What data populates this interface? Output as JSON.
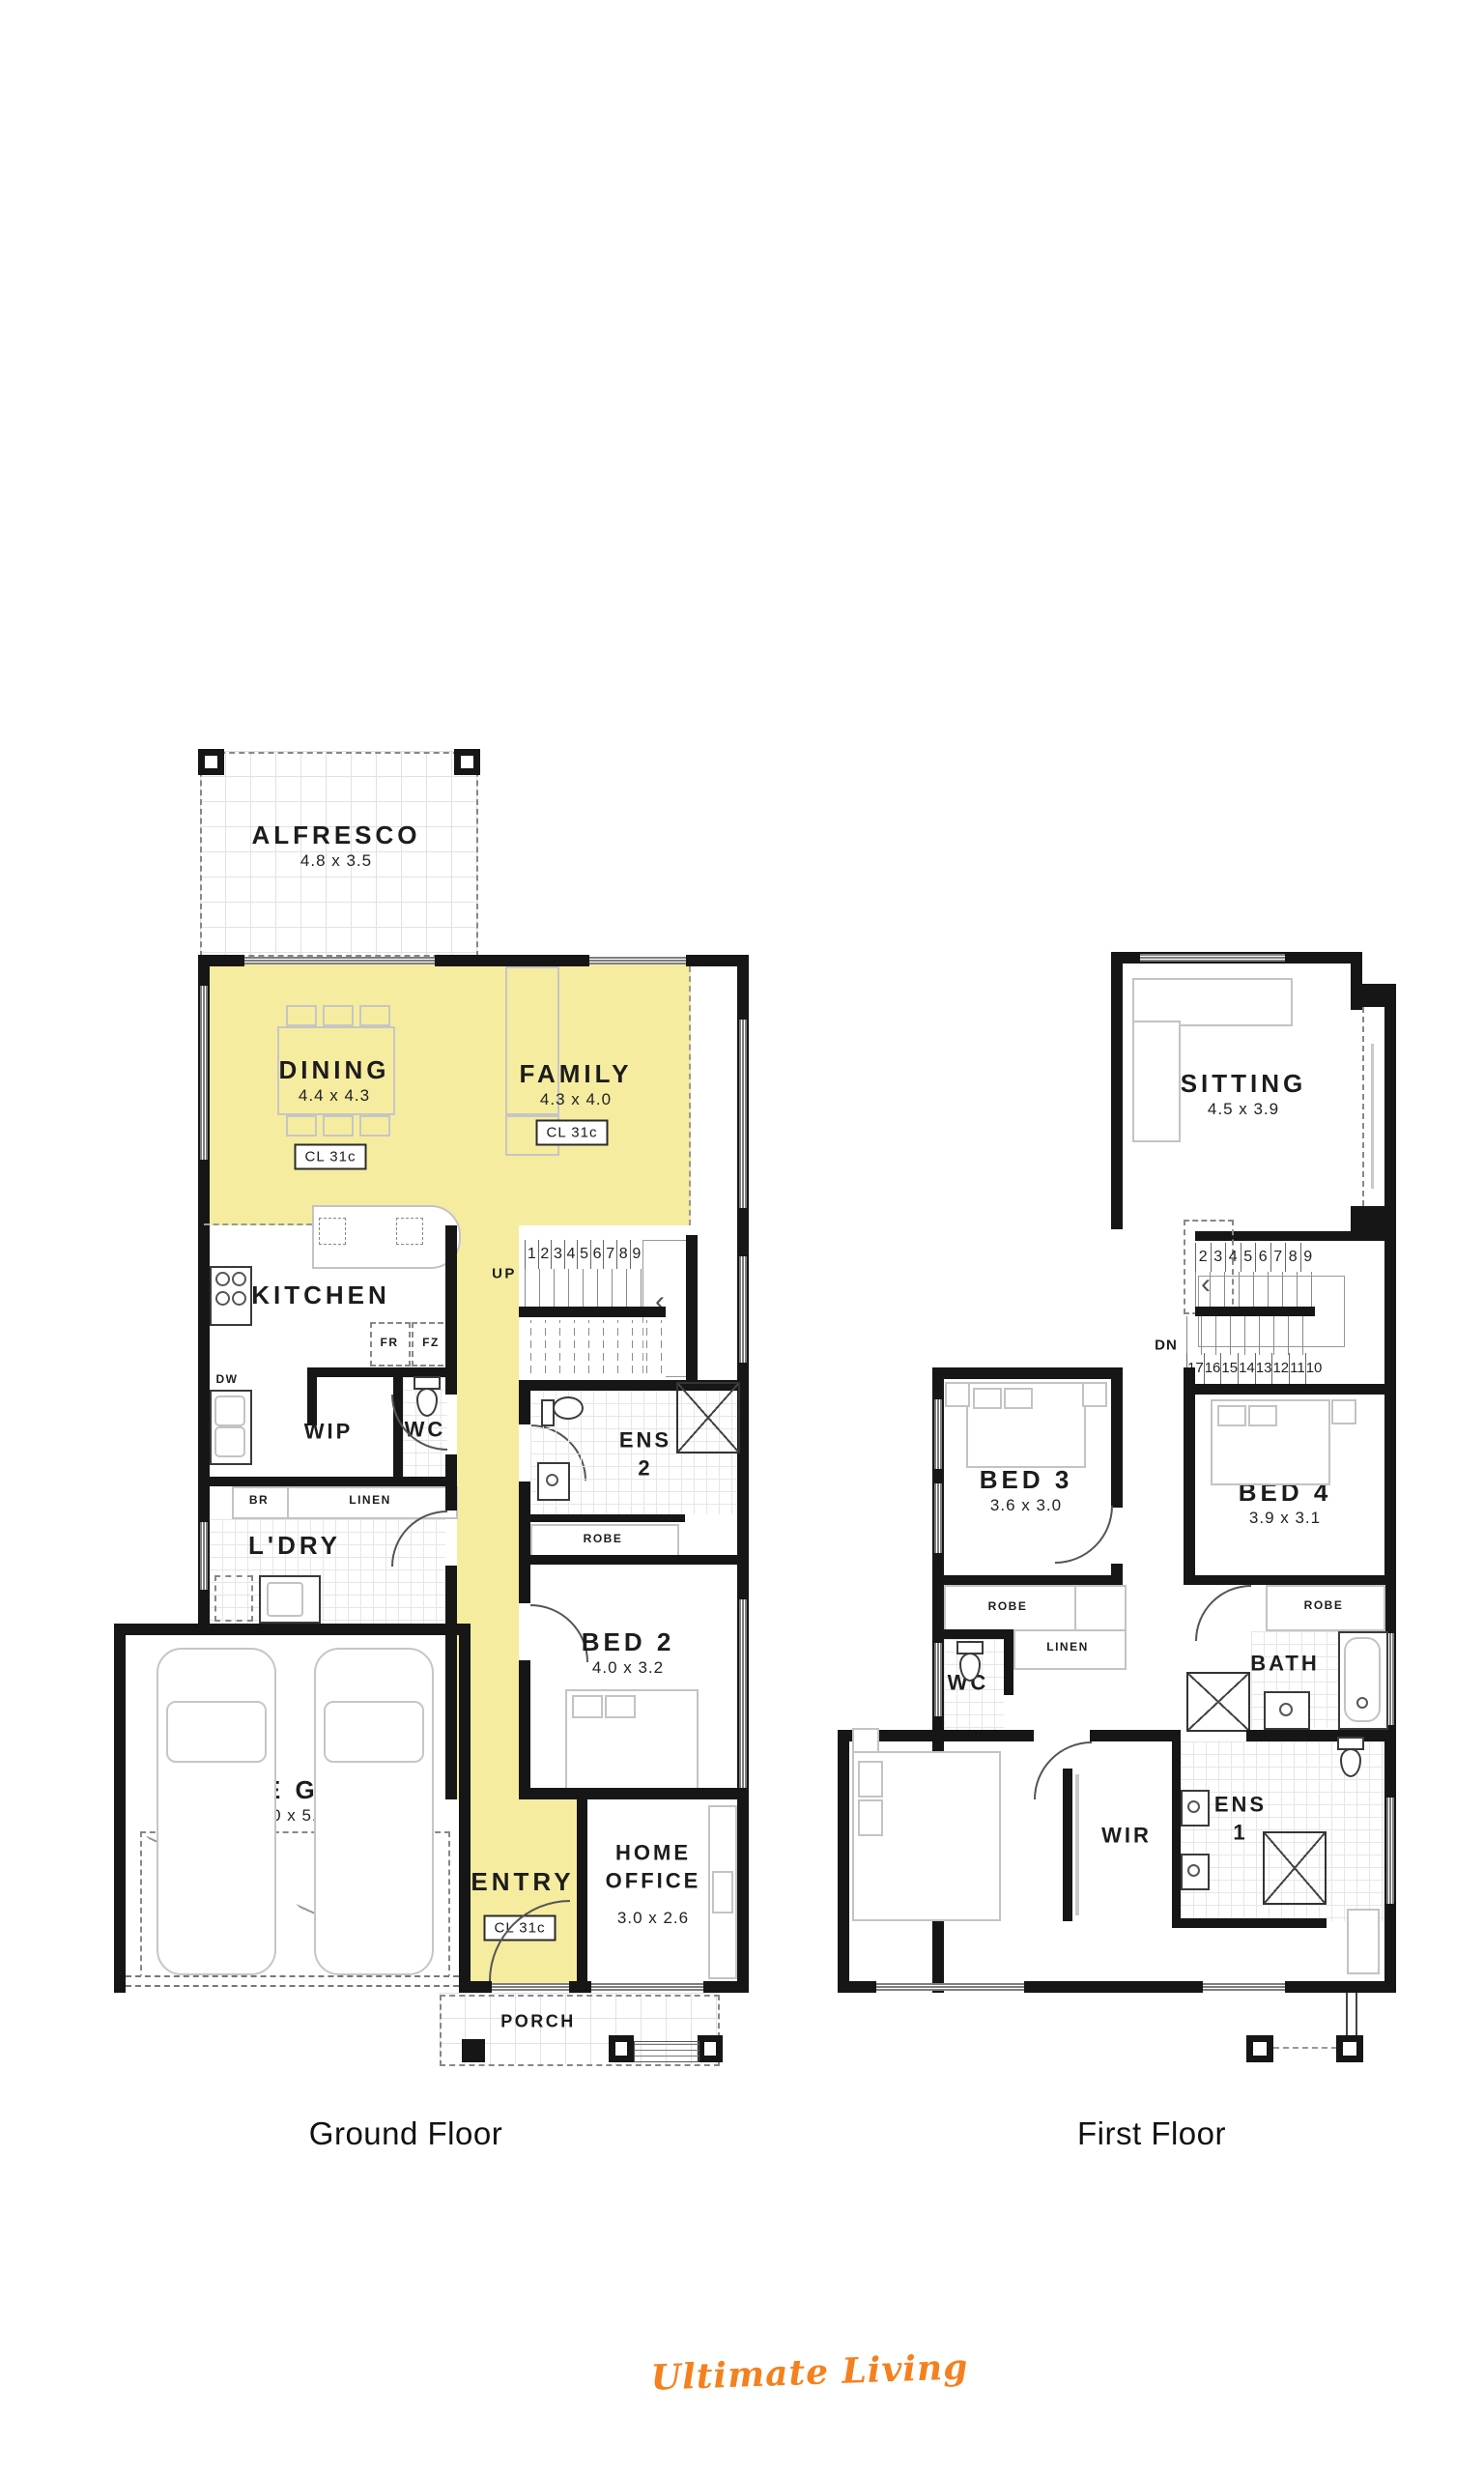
{
  "gf": {
    "caption": "Ground Floor",
    "alfresco_name": "ALFRESCO",
    "alfresco_dim": "4.8 x 3.5",
    "dining_name": "DINING",
    "dining_dim": "4.4 x 4.3",
    "dining_cl": "CL 31c",
    "family_name": "FAMILY",
    "family_dim": "4.3 x 4.0",
    "family_cl": "CL 31c",
    "kitchen_name": "KITCHEN",
    "wip_name": "WIP",
    "wc_name": "WC",
    "ens2_name": "ENS\n2",
    "ldry_name": "L'DRY",
    "bed2_name": "BED 2",
    "bed2_dim": "4.0 x 3.2",
    "garage_name": "DOUBLE GARAGE",
    "garage_dim": "6.0 x 5.9",
    "entry_name": "ENTRY",
    "entry_cl": "CL 31c",
    "office_name": "HOME\nOFFICE",
    "office_dim": "3.0 x 2.6",
    "porch_name": "PORCH",
    "up_label": "UP",
    "fr": "FR",
    "fz": "FZ",
    "dw": "DW",
    "br": "BR",
    "linen": "LINEN",
    "robe": "ROBE",
    "stairs": [
      "1",
      "2",
      "3",
      "4",
      "5",
      "6",
      "7",
      "8",
      "9"
    ]
  },
  "ff": {
    "caption": "First Floor",
    "sitting_name": "SITTING",
    "sitting_dim": "4.5 x 3.9",
    "bed3_name": "BED 3",
    "bed3_dim": "3.6 x 3.0",
    "bed4_name": "BED 4",
    "bed4_dim": "3.9 x 3.1",
    "bed1_name": "BED 1",
    "bed1_dim": "4.1 x 4.0",
    "wc_name": "WC",
    "bath_name": "BATH",
    "wir_name": "WIR",
    "ens1_name": "ENS\n1",
    "linen": "LINEN",
    "robe_bed3": "ROBE",
    "robe_bed4": "ROBE",
    "dn_label": "DN",
    "stairs_top": [
      "2",
      "3",
      "4",
      "5",
      "6",
      "7",
      "8",
      "9"
    ],
    "stairs_bottom": [
      "17",
      "16",
      "15",
      "14",
      "13",
      "12",
      "11",
      "10"
    ]
  },
  "footer": {
    "brand": "Ultimate Living"
  },
  "colors": {
    "highlight": "#F6EC9F",
    "brand_orange": "#F5811E",
    "wall": "#161616"
  }
}
